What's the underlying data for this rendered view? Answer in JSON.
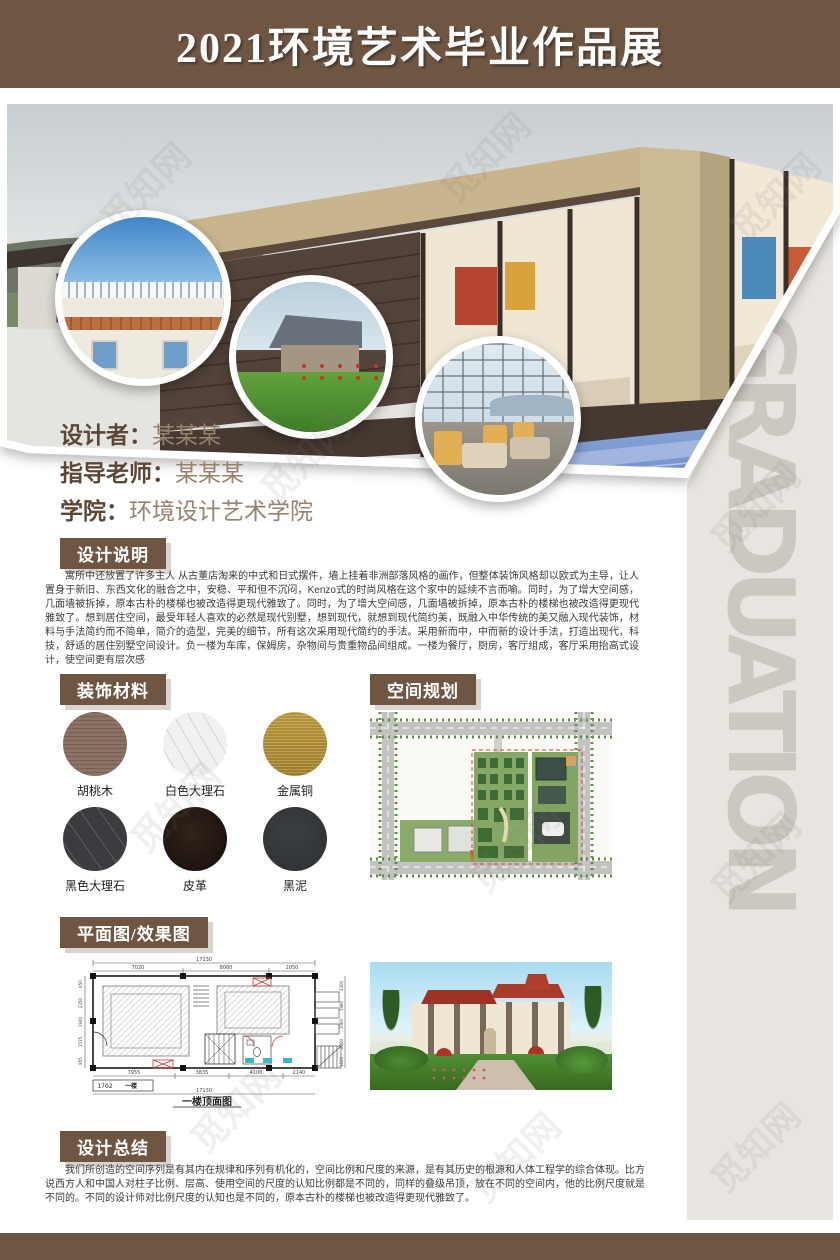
{
  "poster": {
    "title": "2021环境艺术毕业作品展",
    "watermark": "觅知网",
    "side_text": "GRADUATION"
  },
  "info": {
    "designer_label": "设计者：",
    "designer_value": "某某某",
    "advisor_label": "指导老师：",
    "advisor_value": "某某某",
    "college_label": "学院：",
    "college_value": "环境设计艺术学院"
  },
  "sections": {
    "description": {
      "title": "设计说明",
      "body": "寓所中还放置了许多主人  从古董店淘来的中式和日式摆件，墙上挂着非洲部落风格的画作，但整体装饰风格却以欧式为主导，让人置身于新旧、东西文化的融合之中，安稳、平和但不沉闷，Kenzo式的时尚风格在这个家中的延续不言而喻。同时，为了增大空间感，几面墙被拆掉，原本古朴的楼梯也被改造得更现代雅致了。同时，为了增大空间感，几面墙被拆掉，原本古朴的楼梯也被改造得更现代雅致了。想到居住空间，最受年轻人喜欢的必然是现代别墅，想到现代，就想到现代简约美，既融入中华传统的美又融入现代装饰，材料与手法简约而不简单，简介的造型，完美的细节，所有这次采用现代简约的手法。采用新而中，中而新的设计手法，打造出现代，科技，舒适的居住别墅空间设计。负一楼为车库，保姆房，杂物间与贵重物品间组成。一楼为餐厅，厨房，客厅组成，客厅采用抬高式设计，使空间更有层次感"
    },
    "materials": {
      "title": "装饰材料",
      "items": [
        {
          "name": "胡桃木",
          "color": "#8b7265"
        },
        {
          "name": "白色大理石",
          "color": "#f2f1ef"
        },
        {
          "name": "金属铜",
          "color": "#ad8c3e"
        },
        {
          "name": "黑色大理石",
          "color": "#3c3c40"
        },
        {
          "name": "皮革",
          "color": "#251a12"
        },
        {
          "name": "黑泥",
          "color": "#37393c"
        }
      ]
    },
    "planning": {
      "title": "空间规划"
    },
    "plans": {
      "title": "平面图/效果图",
      "floorplan": {
        "top_total": "17130",
        "top_segs": [
          "7020",
          "8060",
          "2050"
        ],
        "bottom_segs": [
          "7955",
          "3835",
          "4100",
          "2140"
        ],
        "bottom_total": "17130",
        "left_segs": [
          "650",
          "2350",
          "1940",
          "1515",
          "955"
        ],
        "right_segs": [
          "3300",
          "1980",
          "1060",
          "2800",
          "1620"
        ],
        "unit_no": "1702",
        "unit_name": "一楼",
        "caption": "一楼顶面图"
      }
    },
    "summary": {
      "title": "设计总结",
      "body": "我们所创造的空间序列是有其内在规律和序列有机化的，空间比例和尺度的来源，是有其历史的根源和人体工程学的综合体现。比方说西方人和中国人对柱子比例、层高、使用空间的尺度的认知比例都是不同的，同样的叠级吊顶，放在不同的空间内，他的比例尺度就是不同的。不同的设计师对比例尺度的认知也是不同的，原本古朴的楼梯也被改造得更现代雅致了。"
    }
  },
  "colors": {
    "header_brown": "#6f5643",
    "panel_gray": "#e8e4df",
    "side_text_gray": "#ccc7c1"
  }
}
